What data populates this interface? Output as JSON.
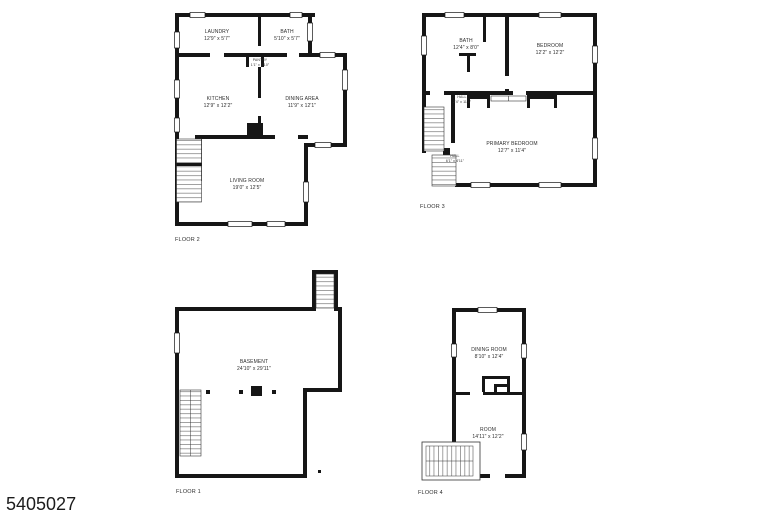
{
  "page": {
    "listing_id": "5405027",
    "background": "#ffffff",
    "wall_color": "#161616",
    "text_color": "#2e2e2e"
  },
  "floors": [
    {
      "label": "FLOOR 2",
      "rooms": [
        {
          "name": "LAUNDRY",
          "dims": "12'9\" x 5'7\""
        },
        {
          "name": "BATH",
          "dims": "5'10\" x 5'7\""
        },
        {
          "name": "PANTRY",
          "dims": "1'1\" x 1'10\""
        },
        {
          "name": "KITCHEN",
          "dims": "12'9\" x 12'2\""
        },
        {
          "name": "DINING AREA",
          "dims": "11'9\" x 12'1\""
        },
        {
          "name": "LIVING ROOM",
          "dims": "19'0\" x 12'5\""
        }
      ]
    },
    {
      "label": "FLOOR 3",
      "rooms": [
        {
          "name": "BATH",
          "dims": "12'4\" x 8'0\""
        },
        {
          "name": "BEDROOM",
          "dims": "12'2\" x 12'2\""
        },
        {
          "name": "HALL",
          "dims": "2'4\" x 11'1\""
        },
        {
          "name": "PRIMARY BEDROOM",
          "dims": "12'7\" x 11'4\""
        },
        {
          "name": "HALL",
          "dims": "6'1\" x 4'11\""
        }
      ]
    },
    {
      "label": "FLOOR 1",
      "rooms": [
        {
          "name": "BASEMENT",
          "dims": "24'10\" x 29'11\""
        }
      ]
    },
    {
      "label": "FLOOR 4",
      "rooms": [
        {
          "name": "DINING ROOM",
          "dims": "8'10\" x 12'4\""
        },
        {
          "name": "ROOM",
          "dims": "14'11\" x 12'2\""
        }
      ]
    }
  ]
}
